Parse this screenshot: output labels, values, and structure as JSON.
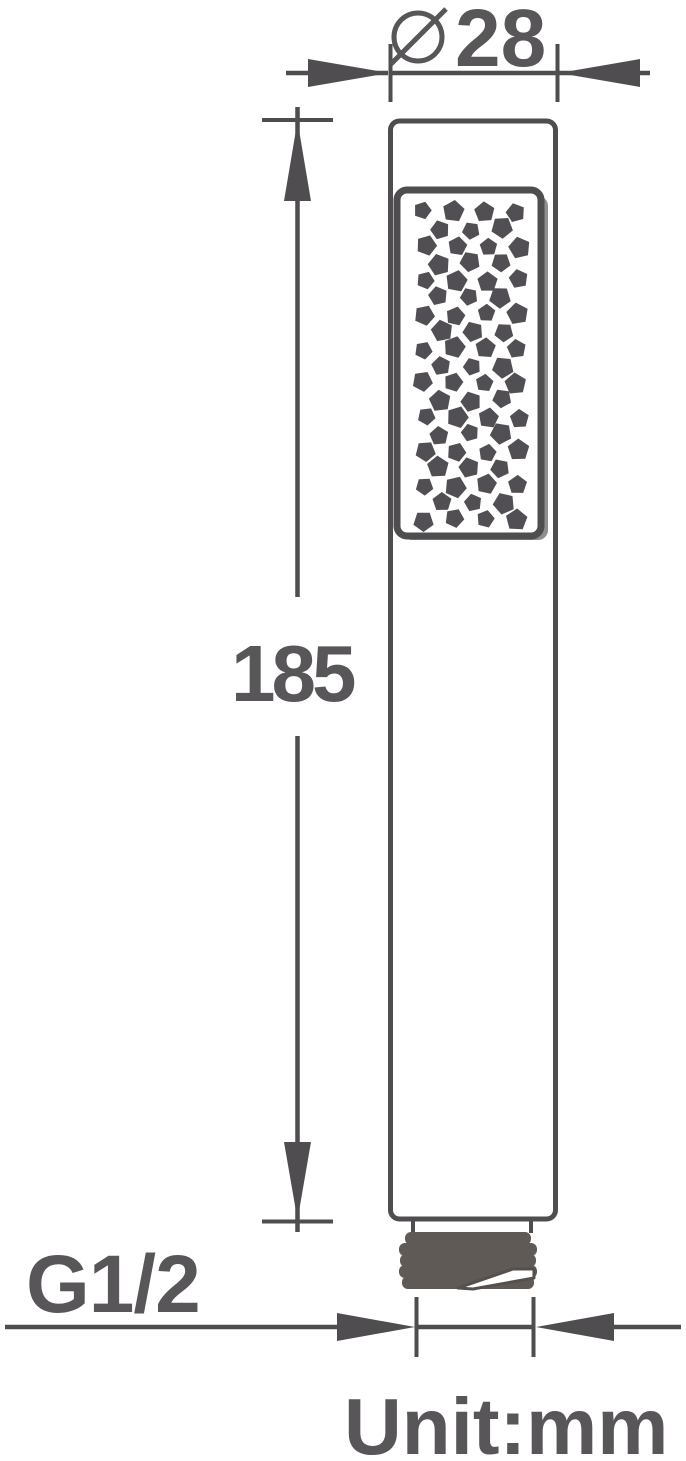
{
  "diagram": {
    "labels": {
      "diameter_value": "28",
      "length_value": "185",
      "thread_size": "G1/2",
      "unit": "Unit:mm"
    },
    "colors": {
      "line": "#4f4d4f",
      "text": "#595659",
      "dot": "#514f53",
      "thread": "#5f5a56",
      "plate_shadow": "#8f8f8f",
      "background": "#ffffff"
    },
    "spray_pattern": {
      "rows": 19,
      "dots_in_even_rows": 4,
      "dots_in_odd_rows": 3
    }
  }
}
